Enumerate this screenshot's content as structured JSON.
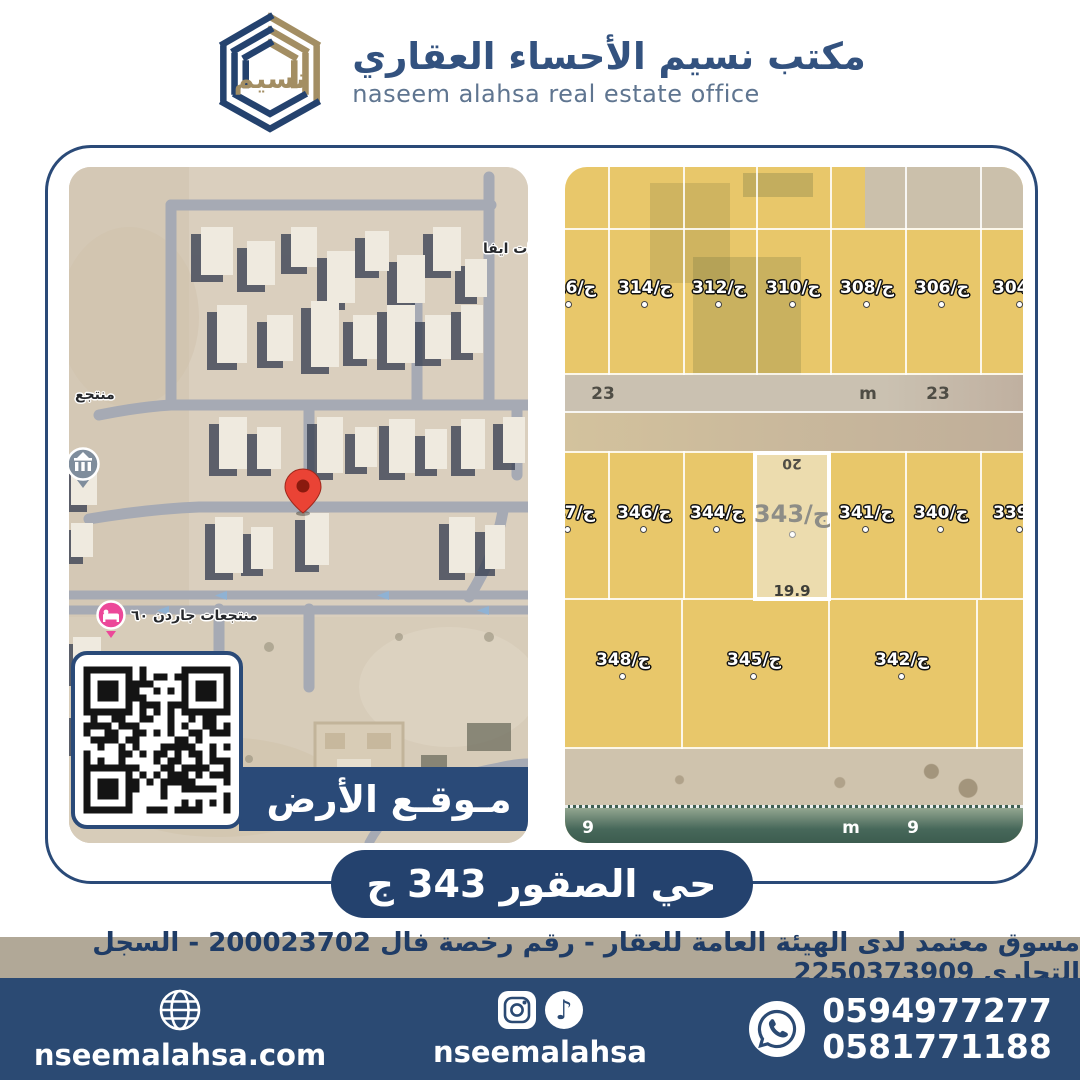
{
  "header": {
    "title_ar": "مكتب نسيم الأحساء العقاري",
    "title_en": "naseem alahsa real estate office",
    "logo_mark": "نسيم"
  },
  "left_map": {
    "poi_top": "ات ايفا",
    "poi_resort": "منتجع",
    "poi_garden": "منتجعات جاردن ٦٠",
    "banner_label": "مـوقـع الأرض"
  },
  "right_map": {
    "row1": [
      "ج/316",
      "ج/314",
      "ج/312",
      "ج/310",
      "ج/308",
      "ج/306",
      "ج/304"
    ],
    "street_top": [
      "23",
      "m",
      "23"
    ],
    "row2": [
      "ج/347",
      "ج/346",
      "ج/344",
      "ج/341",
      "ج/340",
      "ج/339"
    ],
    "selected": {
      "label": "ج/343",
      "dim_top": "20",
      "dim_bottom": "19.9"
    },
    "row3": [
      "ج/348",
      "ج/345",
      "ج/342"
    ],
    "street_bottom": [
      "9",
      "m",
      "9"
    ]
  },
  "district_banner": "حي الصقور 343 ج",
  "license_bar": "مسوق معتمد لدى الهيئة العامة للعقار - رقم رخصة فال 200023702 - السجل التجاري 2250373909",
  "footer": {
    "website": "nseemalahsa.com",
    "social_handle": "nseemalahsa",
    "phone1": "0594977277",
    "phone2": "0581771188"
  },
  "colors": {
    "navy": "#24426e",
    "footer_navy": "#2b4a73",
    "tan_bar": "#b1a897",
    "logo_gold": "#a38e63",
    "plot_yellow": "#e8c76a",
    "selected_plot": "#ecdcae",
    "pin_red": "#ea4335",
    "hotel_pink": "#ec4899"
  }
}
